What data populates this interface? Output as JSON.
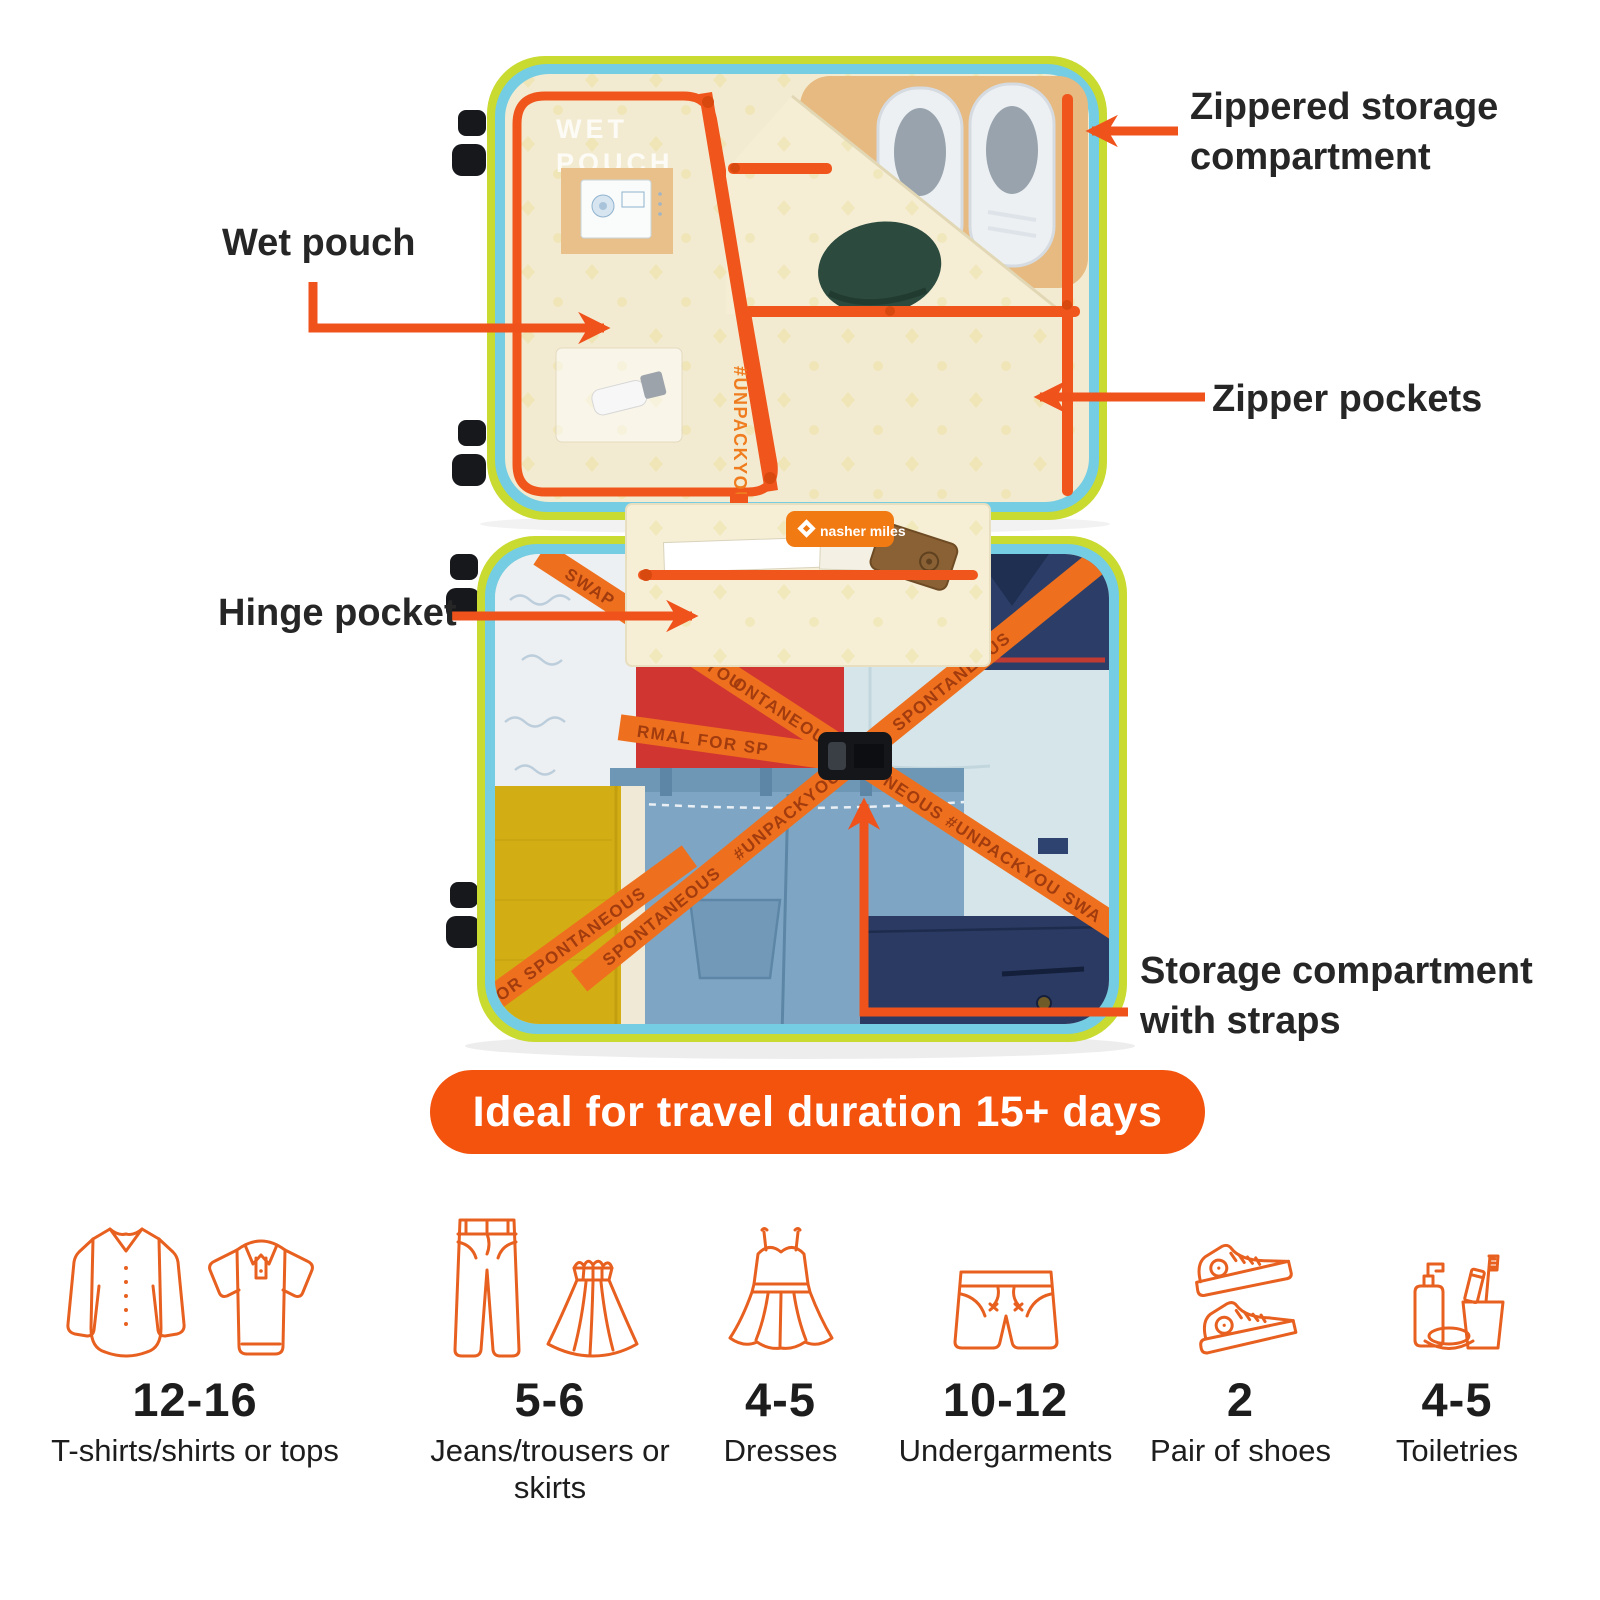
{
  "callouts": {
    "zippered_storage": "Zippered storage compartment",
    "wet_pouch": "Wet pouch",
    "zipper_pockets": "Zipper pockets",
    "hinge_pocket": "Hinge pocket",
    "storage_straps": "Storage compartment with straps"
  },
  "banner": {
    "text": "Ideal for travel duration 15+ days"
  },
  "suitcase": {
    "wet_pouch_print_line1": "WET",
    "wet_pouch_print_line2": "POUCH",
    "lid_hashtag": "#UNPACKYOU",
    "brand_patch": "nasher miles",
    "strap_phrase": "SWAP NORMAL FOR SPONTANEOUS #UNPACKYOU",
    "strap_fragments": [
      "SWAP",
      "#UNPACKYOU",
      "ONTANEOUS",
      "NEOUS  #UNPACKYOU  SWA",
      "SPONTANEOUS",
      "#UNPACKYOU",
      "SPONTANEOUS",
      "RMAL  FOR  SP",
      "FOR  SPONTANEOUS"
    ]
  },
  "capacity": {
    "items": [
      {
        "icon": "shirt-and-polo",
        "count": "12-16",
        "label": "T-shirts/shirts or tops"
      },
      {
        "icon": "jeans-and-skirt",
        "count": "5-6",
        "label": "Jeans/trousers or skirts"
      },
      {
        "icon": "dress",
        "count": "4-5",
        "label": "Dresses"
      },
      {
        "icon": "undergarments",
        "count": "10-12",
        "label": "Undergarments"
      },
      {
        "icon": "sneakers",
        "count": "2",
        "label": "Pair of shoes"
      },
      {
        "icon": "toiletries",
        "count": "4-5",
        "label": "Toiletries"
      }
    ]
  },
  "colors": {
    "accent_orange": "#F0521C",
    "banner_orange": "#F4530E",
    "icon_outline_orange": "#E8601F",
    "shell_lime": "#C9DA30",
    "trim_cyan": "#74CDE2",
    "lining_cream": "#F3EBD1",
    "label_text": "#262626"
  }
}
